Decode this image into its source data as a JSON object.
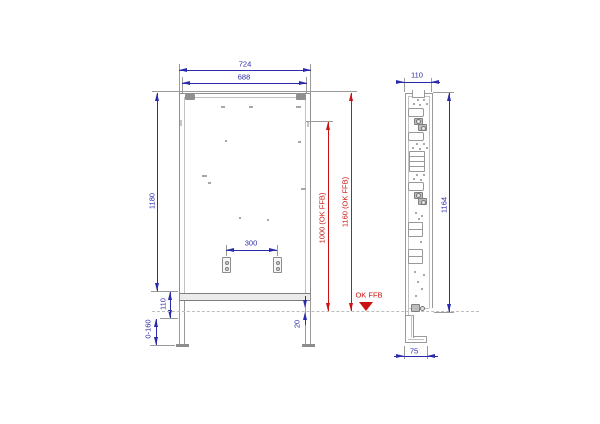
{
  "drawing": {
    "front_view": {
      "width_total": "724",
      "width_inner": "688",
      "height_total": "1180",
      "dim_110": "110",
      "leg_adjust_range": "0-160",
      "fixing_spacing": "300",
      "dim_20": "20",
      "height_1000_ffb": "1000 (OK FFB)",
      "height_1160_ffb": "1160 (OK FFB)",
      "ffb_marker": "OK FFB"
    },
    "side_view": {
      "depth": "110",
      "height": "1164",
      "foot_depth": "75"
    },
    "colors": {
      "dimension_blue": "#2a2aad",
      "annotation_red": "#cb1212",
      "drawing_gray": "#8d8d8d"
    }
  }
}
